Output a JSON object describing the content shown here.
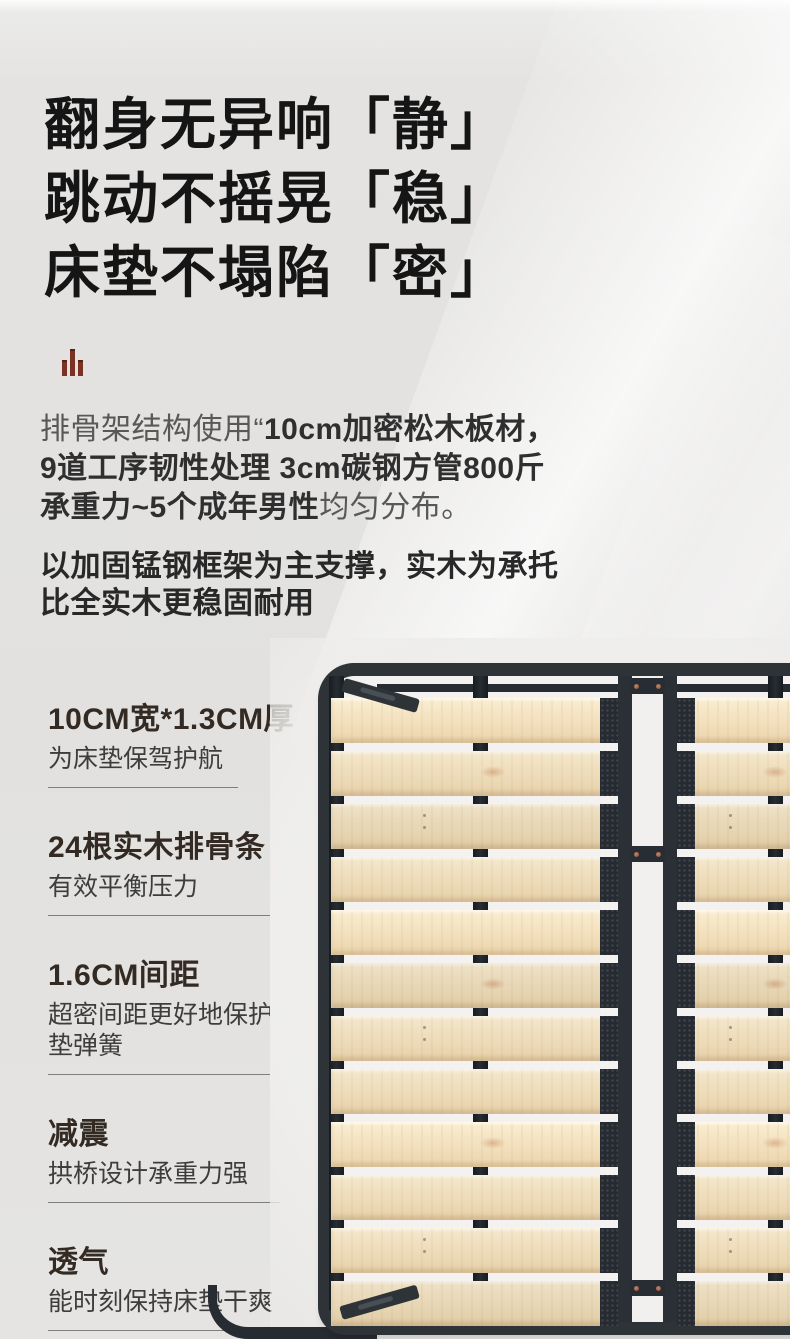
{
  "meta": {
    "type": "product-detail-promo",
    "language": "zh-CN"
  },
  "headline": {
    "lines": [
      "翻身无异响「静」",
      "跳动不摇晃「稳」",
      "床垫不塌陷「密」"
    ]
  },
  "accent_icon": {
    "name": "bar-chart-icon",
    "color": "#7c3223"
  },
  "intro": {
    "p1_segments": [
      {
        "text": "排骨架结构使用“",
        "bold": false
      },
      {
        "text": "10cm加密松木板材，",
        "bold": true,
        "br": true
      },
      {
        "text": "9道工序韧性处理 3cm碳钢方管800斤",
        "bold": true,
        "br": true
      },
      {
        "text": "承重力~5个成年男性",
        "bold": true
      },
      {
        "text": "均匀分布。",
        "bold": false
      }
    ],
    "p2_lines": [
      "以加固锰钢框架为主支撑，实木为承托",
      "比全实木更稳固耐用"
    ]
  },
  "features": [
    {
      "title": "10CM宽*1.3CM厚",
      "desc": "为床垫保驾护航"
    },
    {
      "title": "24根实木排骨条",
      "desc": "有效平衡压力"
    },
    {
      "title": "1.6CM间距",
      "desc": "超密间距更好地保护床垫弹簧"
    },
    {
      "title": "减震",
      "desc": "拱桥设计承重力强"
    },
    {
      "title": "透气",
      "desc": "能时刻保持床垫干爽"
    }
  ],
  "photo": {
    "description": "黑色锰钢框架实木排骨条床架",
    "slats_per_column": 12,
    "colors": {
      "frame": "#2e3338",
      "wood": "#eedcba",
      "gap": "#f3f2f0",
      "background": "#e2e1df"
    }
  }
}
